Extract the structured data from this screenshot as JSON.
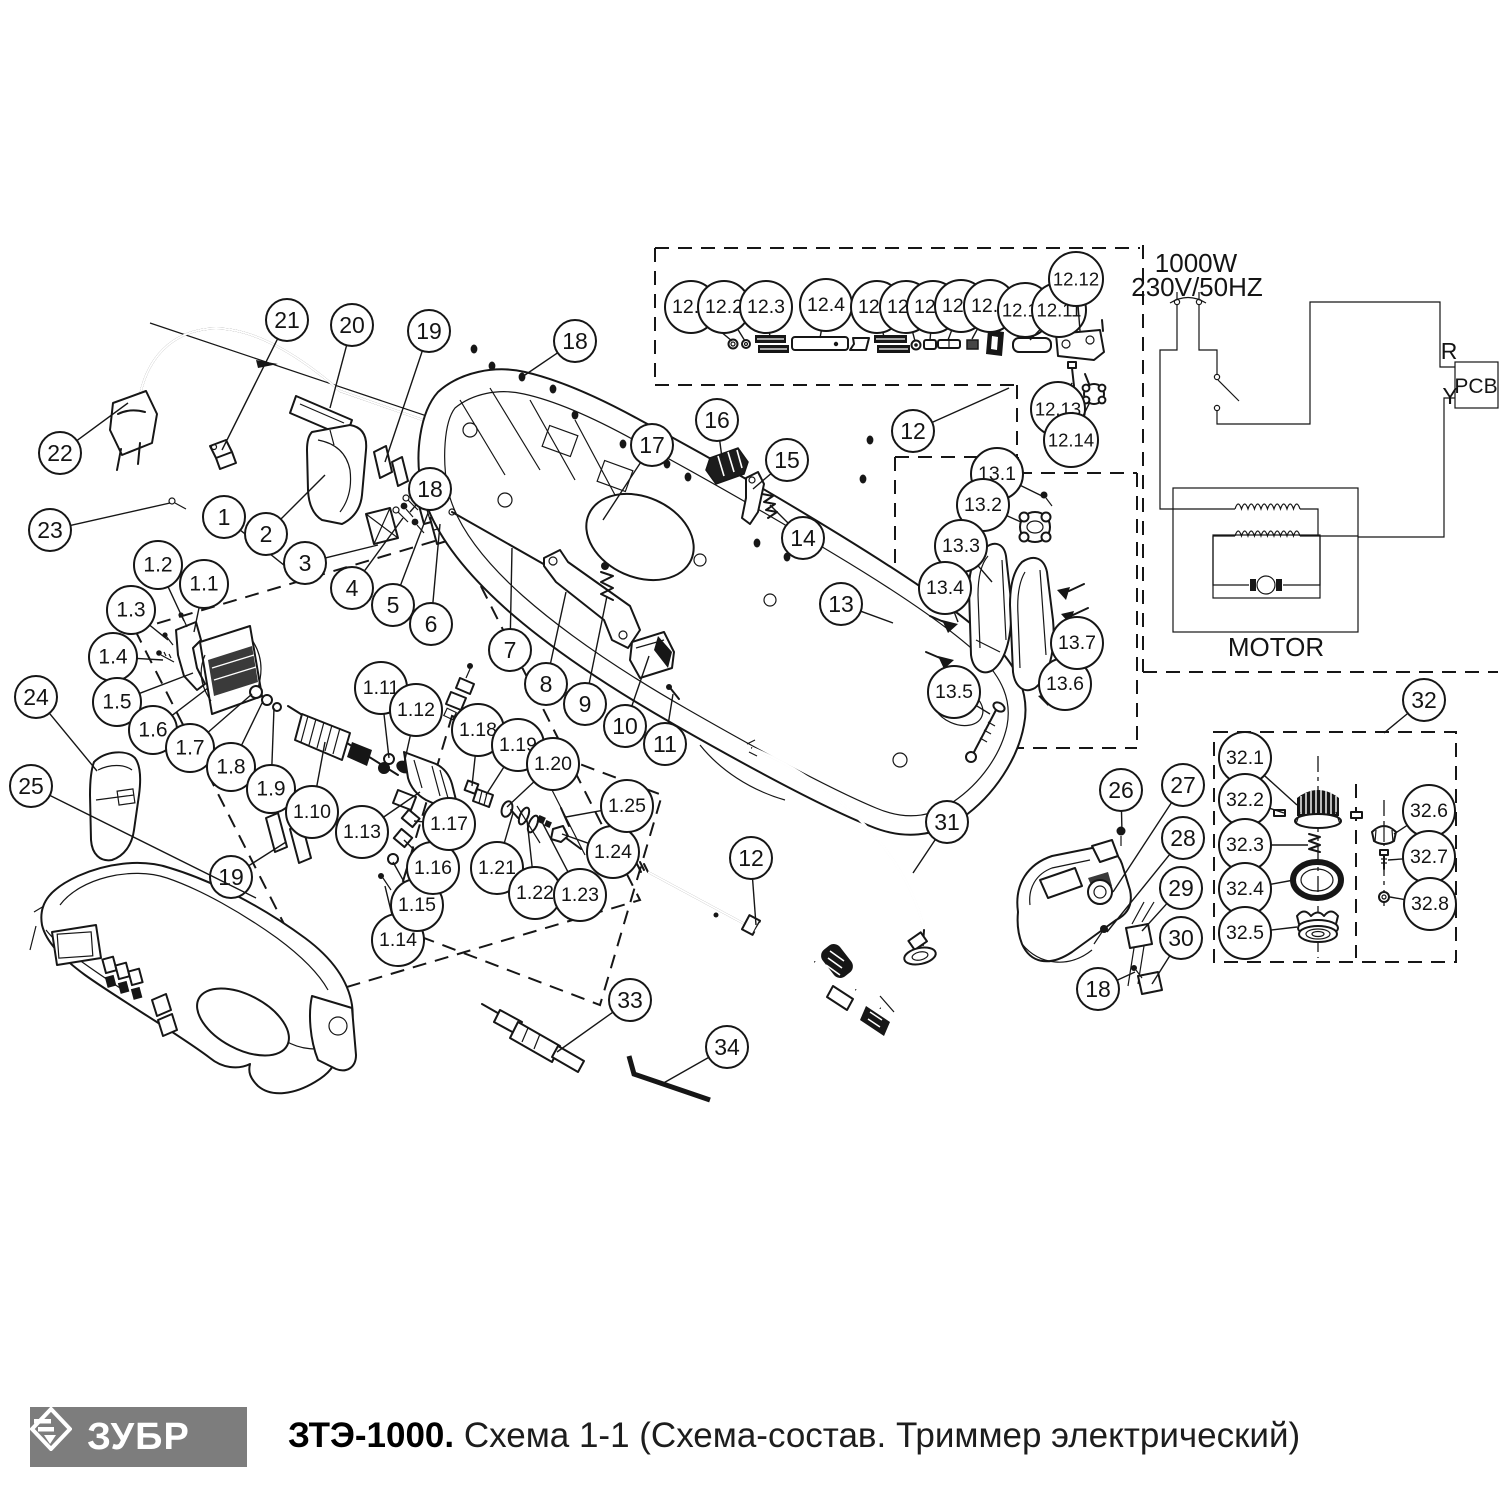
{
  "footer": {
    "logo_text": "ЗУБР",
    "logo_bg": "#7d7d7d",
    "title_bold": "ЗТЭ-1000.",
    "title_rest": " Схема 1-1 (Схема-состав. Триммер электрический)"
  },
  "schematic": {
    "power": "1000W",
    "voltage": "230V/50HZ",
    "pcb": "PCB",
    "motor": "MOTOR",
    "wire_r": "R",
    "wire_y": "Y"
  },
  "colors": {
    "line": "#161616",
    "background": "#ffffff",
    "logo_gray": "#7d7d7d"
  },
  "callouts": [
    {
      "label": "22",
      "cx": 60,
      "cy": 453,
      "tx": 128,
      "ty": 403
    },
    {
      "label": "21",
      "cx": 287,
      "cy": 320,
      "tx": 222,
      "ty": 450
    },
    {
      "label": "20",
      "cx": 352,
      "cy": 325,
      "tx": 330,
      "ty": 408
    },
    {
      "label": "19",
      "cx": 429,
      "cy": 331,
      "tx": 385,
      "ty": 462
    },
    {
      "label": "18",
      "cx": 575,
      "cy": 341,
      "tx": 522,
      "ty": 377
    },
    {
      "label": "23",
      "cx": 50,
      "cy": 530,
      "tx": 170,
      "ty": 503
    },
    {
      "label": "1",
      "cx": 224,
      "cy": 517,
      "tx": 300,
      "ty": 578
    },
    {
      "label": "2",
      "cx": 266,
      "cy": 534,
      "tx": 325,
      "ty": 475
    },
    {
      "label": "3",
      "cx": 305,
      "cy": 563,
      "tx": 378,
      "ty": 545
    },
    {
      "label": "4",
      "cx": 352,
      "cy": 588,
      "tx": 403,
      "ty": 518
    },
    {
      "label": "5",
      "cx": 393,
      "cy": 605,
      "tx": 428,
      "ty": 513
    },
    {
      "label": "6",
      "cx": 431,
      "cy": 624,
      "tx": 440,
      "ty": 524
    },
    {
      "label": "7",
      "cx": 510,
      "cy": 650,
      "tx": 512,
      "ty": 548
    },
    {
      "label": "8",
      "cx": 546,
      "cy": 684,
      "tx": 566,
      "ty": 592
    },
    {
      "label": "9",
      "cx": 585,
      "cy": 704,
      "tx": 607,
      "ty": 596
    },
    {
      "label": "10",
      "cx": 625,
      "cy": 726,
      "tx": 649,
      "ty": 656
    },
    {
      "label": "11",
      "cx": 665,
      "cy": 744,
      "tx": 673,
      "ty": 694
    },
    {
      "label": "17",
      "cx": 652,
      "cy": 445,
      "tx": 603,
      "ty": 520
    },
    {
      "label": "16",
      "cx": 717,
      "cy": 420,
      "tx": 722,
      "ty": 458
    },
    {
      "label": "15",
      "cx": 787,
      "cy": 460,
      "tx": 753,
      "ty": 489
    },
    {
      "label": "14",
      "cx": 803,
      "cy": 538,
      "tx": 770,
      "ty": 505
    },
    {
      "label": "18",
      "cx": 430,
      "cy": 489,
      "tx": 410,
      "ty": 512
    },
    {
      "label": "1.1",
      "cx": 204,
      "cy": 584,
      "tx": 194,
      "ty": 632
    },
    {
      "label": "1.2",
      "cx": 158,
      "cy": 565,
      "tx": 184,
      "ty": 621
    },
    {
      "label": "1.3",
      "cx": 131,
      "cy": 610,
      "tx": 168,
      "ty": 640
    },
    {
      "label": "1.4",
      "cx": 113,
      "cy": 657,
      "tx": 163,
      "ty": 660
    },
    {
      "label": "1.5",
      "cx": 117,
      "cy": 702,
      "tx": 193,
      "ty": 673
    },
    {
      "label": "1.6",
      "cx": 153,
      "cy": 730,
      "tx": 208,
      "ty": 688
    },
    {
      "label": "1.7",
      "cx": 190,
      "cy": 748,
      "tx": 252,
      "ty": 694
    },
    {
      "label": "1.8",
      "cx": 231,
      "cy": 767,
      "tx": 263,
      "ty": 701
    },
    {
      "label": "1.9",
      "cx": 271,
      "cy": 789,
      "tx": 274,
      "ty": 708
    },
    {
      "label": "1.10",
      "cx": 312,
      "cy": 812,
      "tx": 325,
      "ty": 742
    },
    {
      "label": "1.11",
      "cx": 381,
      "cy": 688,
      "tx": 389,
      "ty": 758
    },
    {
      "label": "1.12",
      "cx": 416,
      "cy": 710,
      "tx": 404,
      "ty": 764
    },
    {
      "label": "1.13",
      "cx": 362,
      "cy": 832,
      "tx": 420,
      "ty": 792
    },
    {
      "label": "1.14",
      "cx": 398,
      "cy": 940,
      "tx": 385,
      "ty": 886
    },
    {
      "label": "1.15",
      "cx": 417,
      "cy": 905,
      "tx": 393,
      "ty": 862
    },
    {
      "label": "1.16",
      "cx": 433,
      "cy": 868,
      "tx": 404,
      "ty": 840
    },
    {
      "label": "1.17",
      "cx": 449,
      "cy": 824,
      "tx": 414,
      "ty": 821
    },
    {
      "label": "1.18",
      "cx": 478,
      "cy": 730,
      "tx": 472,
      "ty": 786
    },
    {
      "label": "1.19",
      "cx": 518,
      "cy": 745,
      "tx": 486,
      "ty": 795
    },
    {
      "label": "1.20",
      "cx": 553,
      "cy": 764,
      "tx": 507,
      "ty": 807
    },
    {
      "label": "1.21",
      "cx": 497,
      "cy": 868,
      "tx": 513,
      "ty": 813
    },
    {
      "label": "1.22",
      "cx": 535,
      "cy": 893,
      "tx": 527,
      "ty": 820
    },
    {
      "label": "1.23",
      "cx": 580,
      "cy": 895,
      "tx": 542,
      "ty": 822
    },
    {
      "label": "1.24",
      "cx": 613,
      "cy": 852,
      "tx": 562,
      "ty": 834
    },
    {
      "label": "1.25",
      "cx": 627,
      "cy": 806,
      "tx": 566,
      "ty": 817
    },
    {
      "label": "19",
      "cx": 231,
      "cy": 877,
      "tx": 286,
      "ty": 842
    },
    {
      "label": "24",
      "cx": 36,
      "cy": 697,
      "tx": 97,
      "ty": 771
    },
    {
      "label": "25",
      "cx": 31,
      "cy": 786,
      "tx": 256,
      "ty": 898
    },
    {
      "label": "12",
      "cx": 913,
      "cy": 431,
      "tx": 1009,
      "ty": 388
    },
    {
      "label": "12.1",
      "cx": 691,
      "cy": 307,
      "tx": 732,
      "ty": 341
    },
    {
      "label": "12.2",
      "cx": 724,
      "cy": 307,
      "tx": 745,
      "ty": 341
    },
    {
      "label": "12.3",
      "cx": 766,
      "cy": 307,
      "tx": 770,
      "ty": 337
    },
    {
      "label": "12.4",
      "cx": 826,
      "cy": 305,
      "tx": 820,
      "ty": 338
    },
    {
      "label": "12.5",
      "cx": 877,
      "cy": 307,
      "tx": 884,
      "ty": 337
    },
    {
      "label": "12.6",
      "cx": 906,
      "cy": 307,
      "tx": 915,
      "ty": 341
    },
    {
      "label": "12.7",
      "cx": 933,
      "cy": 307,
      "tx": 930,
      "ty": 340
    },
    {
      "label": "12.8",
      "cx": 961,
      "cy": 306,
      "tx": 948,
      "ty": 340
    },
    {
      "label": "12.9",
      "cx": 990,
      "cy": 306,
      "tx": 972,
      "ty": 339
    },
    {
      "label": "12.10",
      "cx": 1025,
      "cy": 310,
      "tx": 996,
      "ty": 334
    },
    {
      "label": "12.11",
      "cx": 1059,
      "cy": 310,
      "tx": 1030,
      "ty": 340
    },
    {
      "label": "12.12",
      "cx": 1076,
      "cy": 279,
      "tx": 1080,
      "ty": 331
    },
    {
      "label": "12.13",
      "cx": 1058,
      "cy": 409,
      "tx": 1072,
      "ty": 383
    },
    {
      "label": "12.14",
      "cx": 1071,
      "cy": 440,
      "tx": 1090,
      "ty": 402
    },
    {
      "label": "13",
      "cx": 841,
      "cy": 604,
      "tx": 893,
      "ty": 623
    },
    {
      "label": "13.1",
      "cx": 997,
      "cy": 474,
      "tx": 1042,
      "ty": 496
    },
    {
      "label": "13.2",
      "cx": 983,
      "cy": 505,
      "tx": 1021,
      "ty": 522
    },
    {
      "label": "13.3",
      "cx": 961,
      "cy": 546,
      "tx": 992,
      "ty": 582
    },
    {
      "label": "13.4",
      "cx": 945,
      "cy": 588,
      "tx": 958,
      "ty": 622
    },
    {
      "label": "13.5",
      "cx": 954,
      "cy": 692,
      "tx": 990,
      "ty": 714
    },
    {
      "label": "13.6",
      "cx": 1065,
      "cy": 684,
      "tx": 1050,
      "ty": 678
    },
    {
      "label": "13.7",
      "cx": 1077,
      "cy": 643,
      "tx": 1066,
      "ty": 622
    },
    {
      "label": "12",
      "cx": 751,
      "cy": 858,
      "tx": 756,
      "ty": 925
    },
    {
      "label": "31",
      "cx": 947,
      "cy": 822,
      "tx": 913,
      "ty": 873
    },
    {
      "label": "33",
      "cx": 630,
      "cy": 1000,
      "tx": 557,
      "ty": 1052
    },
    {
      "label": "34",
      "cx": 727,
      "cy": 1047,
      "tx": 660,
      "ty": 1085
    },
    {
      "label": "26",
      "cx": 1121,
      "cy": 790,
      "tx": 1122,
      "ty": 833
    },
    {
      "label": "27",
      "cx": 1183,
      "cy": 785,
      "tx": 1113,
      "ty": 892
    },
    {
      "label": "28",
      "cx": 1183,
      "cy": 838,
      "tx": 1107,
      "ty": 932
    },
    {
      "label": "29",
      "cx": 1181,
      "cy": 888,
      "tx": 1142,
      "ty": 931
    },
    {
      "label": "30",
      "cx": 1181,
      "cy": 938,
      "tx": 1152,
      "ty": 984
    },
    {
      "label": "18",
      "cx": 1098,
      "cy": 989,
      "tx": 1135,
      "ty": 972
    },
    {
      "label": "32",
      "cx": 1424,
      "cy": 700,
      "tx": 1384,
      "ty": 733
    },
    {
      "label": "32.1",
      "cx": 1245,
      "cy": 758,
      "tx": 1297,
      "ty": 805
    },
    {
      "label": "32.2",
      "cx": 1245,
      "cy": 800,
      "tx": 1284,
      "ty": 813
    },
    {
      "label": "32.3",
      "cx": 1245,
      "cy": 845,
      "tx": 1308,
      "ty": 845
    },
    {
      "label": "32.4",
      "cx": 1245,
      "cy": 889,
      "tx": 1294,
      "ty": 880
    },
    {
      "label": "32.5",
      "cx": 1245,
      "cy": 933,
      "tx": 1297,
      "ty": 927
    },
    {
      "label": "32.6",
      "cx": 1429,
      "cy": 811,
      "tx": 1394,
      "ty": 834
    },
    {
      "label": "32.7",
      "cx": 1429,
      "cy": 857,
      "tx": 1388,
      "ty": 860
    },
    {
      "label": "32.8",
      "cx": 1430,
      "cy": 904,
      "tx": 1390,
      "ty": 897
    }
  ]
}
